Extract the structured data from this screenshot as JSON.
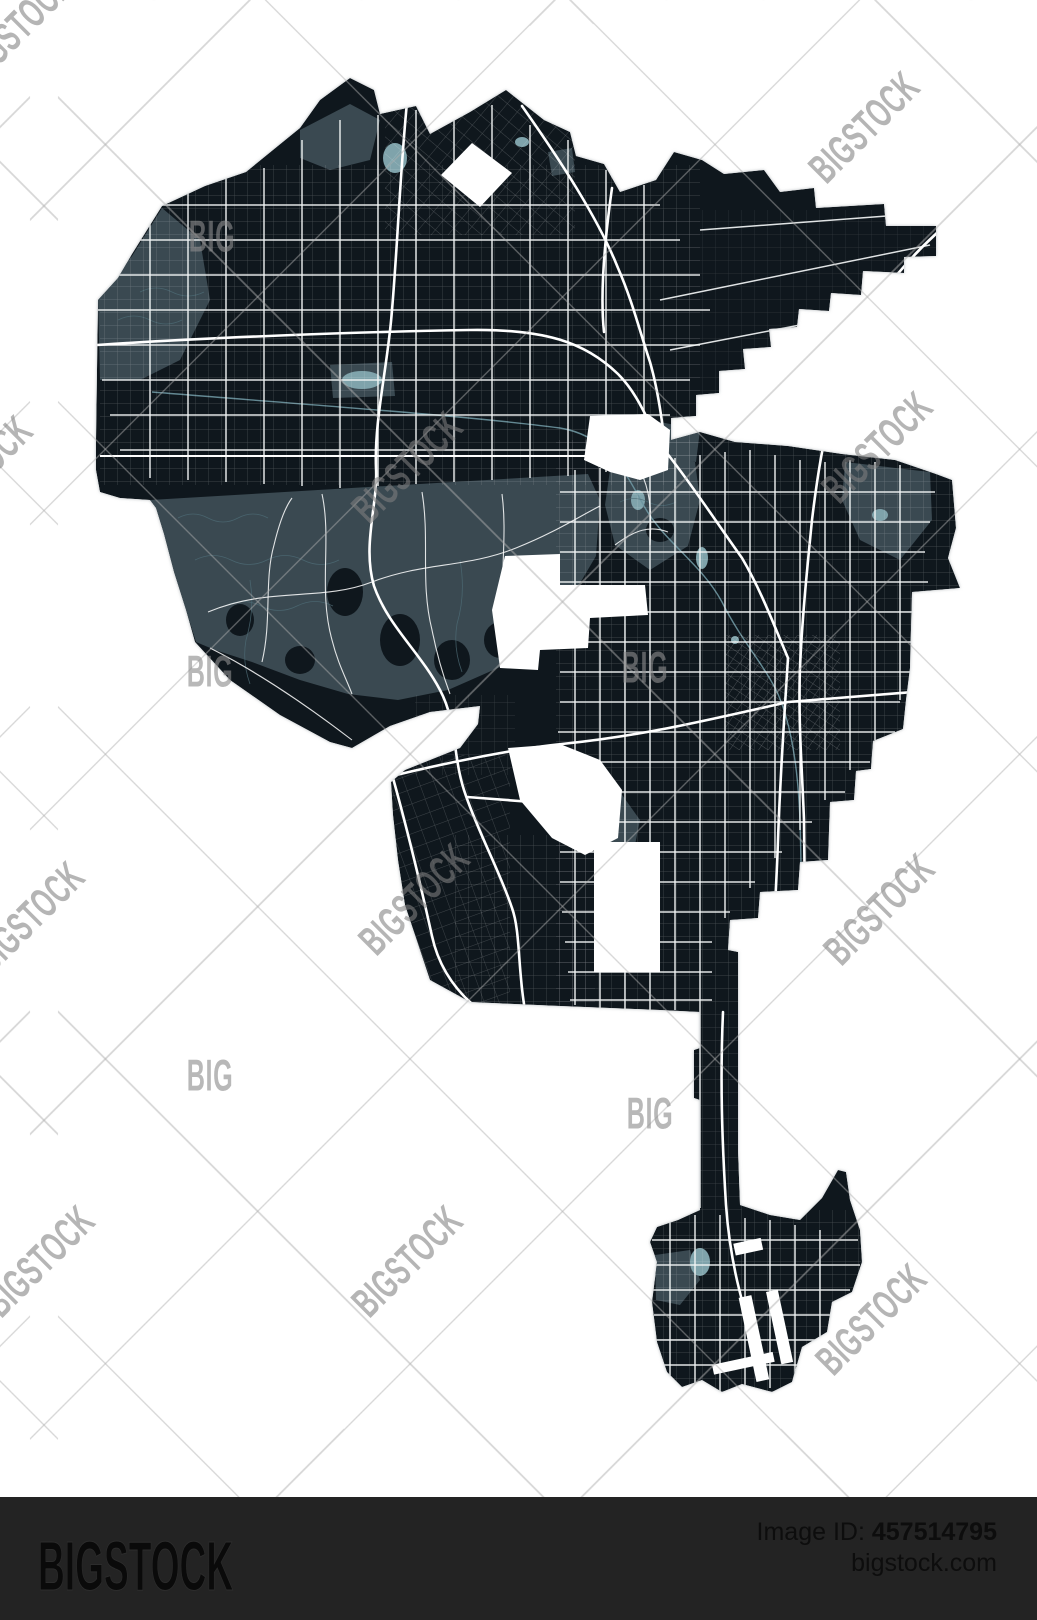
{
  "watermark": {
    "brand": "BIGSTOCK",
    "short": "BIG"
  },
  "footer": {
    "logo": "BIGSTOCK",
    "id_label": "Image ID:",
    "id_value": "457514795",
    "site": "bigstock.com"
  },
  "colors": {
    "background": "#ffffff",
    "map_base": "#0f171d",
    "terrain": "#3a4951",
    "water": "#7fa3ab",
    "roads": "#ffffff",
    "footer_bg": "#232323",
    "watermark_gray": "#808080"
  }
}
